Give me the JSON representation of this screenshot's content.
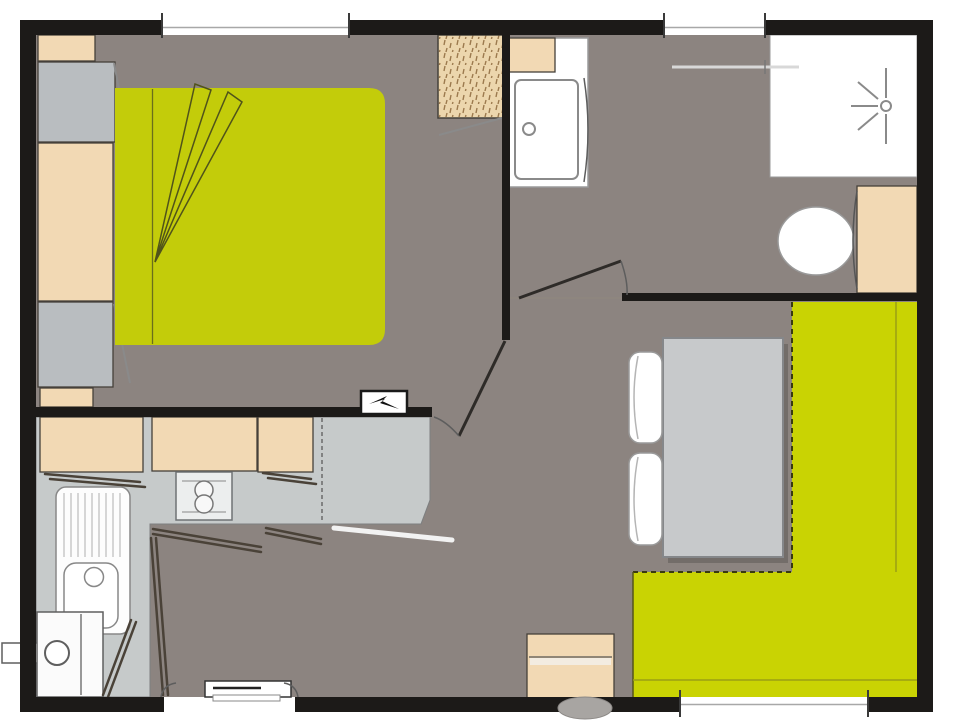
{
  "plan": {
    "kind": "mobile-home floor plan, top-down view, no text labels",
    "rooms": [
      "bedroom",
      "bathroom",
      "kitchen",
      "living-dining"
    ],
    "bedroom_fixtures": [
      "wardrobe-top",
      "wardrobe-cabinet-upper",
      "wardrobe-tall",
      "wardrobe-cabinet-lower",
      "wardrobe-strip",
      "double-bed",
      "hatched-closet"
    ],
    "bathroom_fixtures": [
      "vanity-cabinet",
      "washbasin",
      "shower-tray",
      "shower-head-symbol",
      "toilet",
      "cistern-cabinet",
      "towel-rail"
    ],
    "kitchen_fixtures": [
      "wall-cabinets",
      "worktop",
      "two-burner-hob",
      "sink-with-drainer",
      "water-heater",
      "folding-door-panels",
      "electrical-panel"
    ],
    "living_fixtures": [
      "l-shaped-bench",
      "dining-table",
      "seat-cushions",
      "drawer-unit",
      "stool"
    ],
    "openings": [
      "bedroom-window",
      "bathroom-window",
      "living-window",
      "entrance-door",
      "bedroom-door",
      "bathroom-door"
    ]
  },
  "colors": {
    "wall": "#1c1a18",
    "floor": "#8c8480",
    "bed_green": "#c3cc0a",
    "bench_green": "#c9d303",
    "beige": "#f2d9b4",
    "gray_unit": "#b9bdc0",
    "counter": "#c6caca",
    "table": "#c7c9cb",
    "white": "#ffffff",
    "outline": "#45403a",
    "line_dark": "#2e2b28",
    "line_mid": "#8a8a8a",
    "panel_dark": "#4a4238",
    "closet_beige": "#ecd6ad",
    "hatch_brown": "#9c7a4e"
  }
}
